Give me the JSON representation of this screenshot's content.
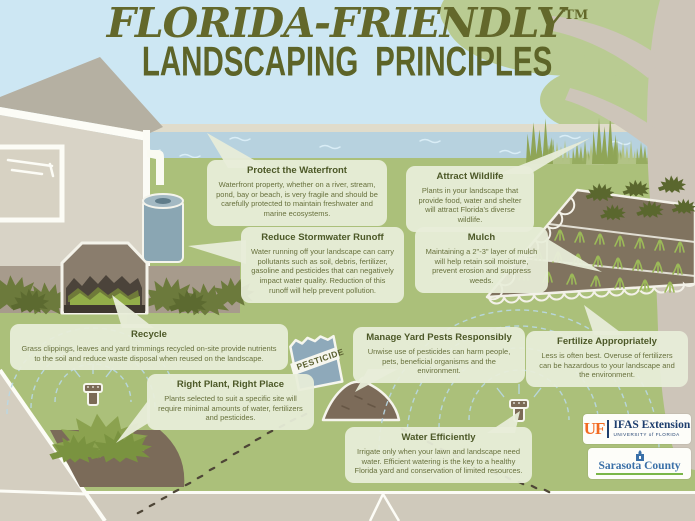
{
  "title": {
    "line1": "FLORIDA-FRIENDLY",
    "trademark": "TM",
    "line2": "LANDSCAPING PRINCIPLES"
  },
  "callouts": [
    {
      "id": "protect-waterfront",
      "title": "Protect the Waterfront",
      "body": "Waterfront property, whether on a river, stream, pond, bay or beach, is very fragile and should be carefully protected to maintain freshwater and marine ecosystems."
    },
    {
      "id": "attract-wildlife",
      "title": "Attract Wildlife",
      "body": "Plants in your landscape that provide food, water and shelter will attract Florida's diverse wildlife."
    },
    {
      "id": "reduce-stormwater-runoff",
      "title": "Reduce Stormwater Runoff",
      "body": "Water running off your landscape can carry pollutants such as soil, debris, fertilizer, gasoline and pesticides that can negatively impact water quality. Reduction of this runoff will help prevent pollution."
    },
    {
      "id": "mulch",
      "title": "Mulch",
      "body": "Maintaining a 2\"-3\" layer of mulch will help retain soil moisture, prevent erosion and suppress weeds."
    },
    {
      "id": "recycle",
      "title": "Recycle",
      "body": "Grass clippings, leaves and yard trimmings recycled on-site provide nutrients to the soil and reduce waste disposal when reused on the landscape."
    },
    {
      "id": "manage-yard-pests",
      "title": "Manage Yard Pests Responsibly",
      "body": "Unwise use of pesticides can harm people, pets, beneficial organisms and the environment."
    },
    {
      "id": "fertilize-appropriately",
      "title": "Fertilize Appropriately",
      "body": "Less is often best. Overuse of fertilizers can be hazardous to your landscape and the environment."
    },
    {
      "id": "right-plant-right-place",
      "title": "Right Plant, Right Place",
      "body": "Plants selected to suit a specific site will require minimal amounts of water, fertilizers and pesticides."
    },
    {
      "id": "water-efficiently",
      "title": "Water Efficiently",
      "body": "Irrigate only when your lawn and landscape need water. Efficient watering is the key to a healthy Florida yard and conservation of limited resources."
    }
  ],
  "scene": {
    "pesticide_bag_label": "PESTICIDE"
  },
  "logos": {
    "uf": {
      "abbr": "UF",
      "name": "IFAS Extension",
      "sub": "UNIVERSITY of FLORIDA"
    },
    "county": {
      "name": "Sarasota County"
    }
  },
  "colors": {
    "sky": "#cde7f3",
    "water": "#b7d2df",
    "lawn": "#abc07a",
    "canopy": "#b9cb92",
    "callout_bg": "#e8edd9",
    "callout_title": "#4c5827",
    "callout_body": "#68713d",
    "title_green": "#63682b",
    "uf_orange": "#f26a21",
    "uf_blue": "#1d3e6e",
    "county_blue": "#3a70a8",
    "county_green": "#7ab648"
  }
}
